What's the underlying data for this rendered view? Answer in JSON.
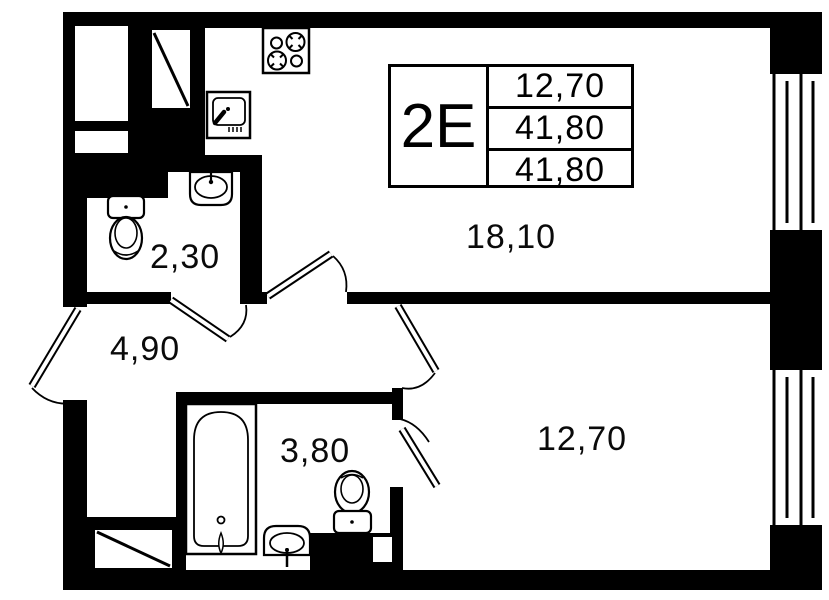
{
  "plan": {
    "info_box": {
      "type": "2E",
      "values": [
        "12,70",
        "41,80",
        "41,80"
      ]
    },
    "rooms": {
      "kitchen_living": "18,10",
      "wc": "2,30",
      "hall": "4,90",
      "bathroom": "3,80",
      "bedroom": "12,70"
    },
    "colors": {
      "wall": "#000000",
      "background": "#ffffff"
    }
  }
}
